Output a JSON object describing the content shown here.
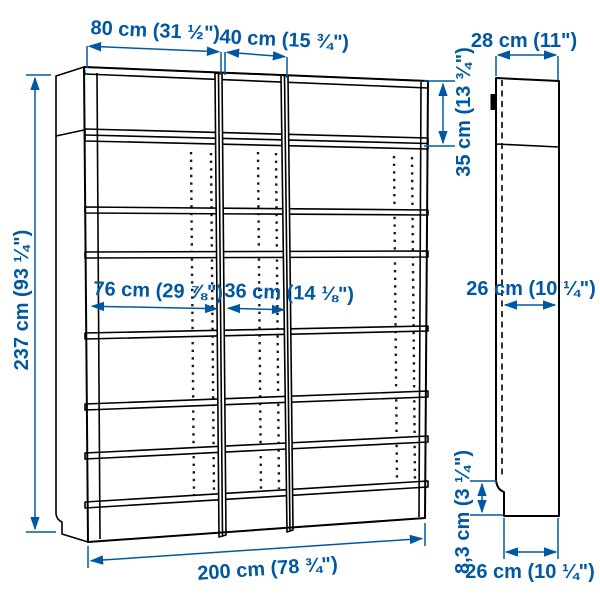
{
  "figure": {
    "kind": "product dimension illustration",
    "subject": "three-section bookcase with height extension units, front elevation and side elevation",
    "background": "#ffffff"
  },
  "colors": {
    "dimension_accent": "#0058a3",
    "line_art": "#000000"
  },
  "labels": {
    "width_section_left": "80 cm (31 ½\")",
    "width_section_middle": "40 cm (15 ¾\")",
    "height_total": "237 cm (93 ¼\")",
    "height_extension": "35 cm (13 ¾\")",
    "width_inner_left": "76 cm (29 ⅞\")",
    "width_inner_middle": "36 cm (14 ⅛\")",
    "width_total": "200 cm (78 ¾\")",
    "depth_top": "28 cm (11\")",
    "depth_shelf": "26 cm (10 ¼\")",
    "height_plinth": "8,3 cm (3 ¼\")",
    "depth_base": "26 cm (10 ¼\")"
  }
}
